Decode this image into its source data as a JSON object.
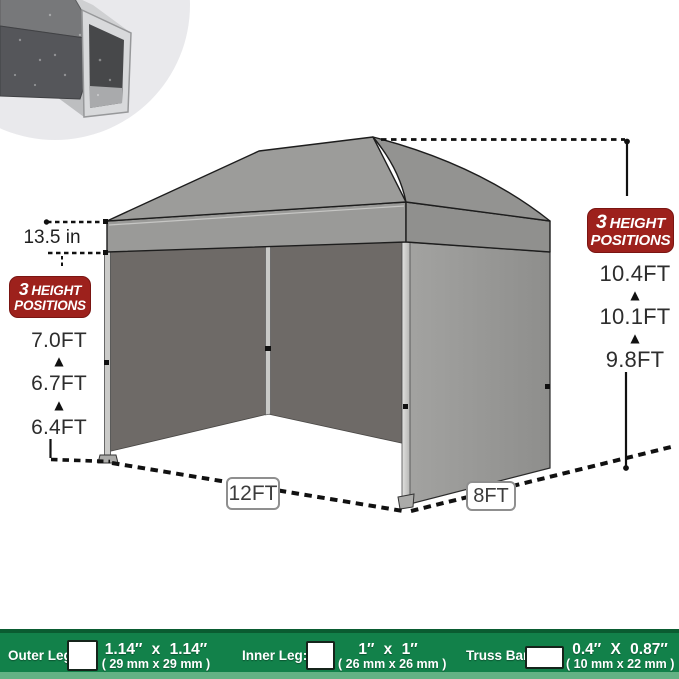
{
  "annotations": {
    "valance_height": "13.5 in",
    "height_badge": {
      "number": "3",
      "word1": "HEIGHT",
      "word2": "POSITIONS"
    },
    "left_heights": [
      "7.0FT",
      "6.7FT",
      "6.4FT"
    ],
    "right_heights": [
      "10.4FT",
      "10.1FT",
      "9.8FT"
    ],
    "base_width": "12FT",
    "base_depth": "8FT"
  },
  "icons": {
    "up_triangle": "▲"
  },
  "spec_bar": {
    "items": [
      {
        "label": "Outer Leg:",
        "size": "1.14″ x 1.14″",
        "metric": "( 29 mm x 29 mm )"
      },
      {
        "label": "Inner Leg:",
        "size": "1″ x 1″",
        "metric": "( 26 mm x 26 mm )"
      },
      {
        "label": "Truss Bar:",
        "size": "0.4″ X 0.87″",
        "metric": "( 10 mm x 22 mm )"
      }
    ]
  },
  "colors": {
    "badge_red": "#9D211C",
    "bar_green": "#12814A",
    "bar_green_dark": "#0A5C31",
    "bar_green_light": "#63B284",
    "tent_gray": "#9A9A98",
    "tent_dark_wall": "#6E6A67",
    "label_box_border": "#8F8F8F"
  }
}
